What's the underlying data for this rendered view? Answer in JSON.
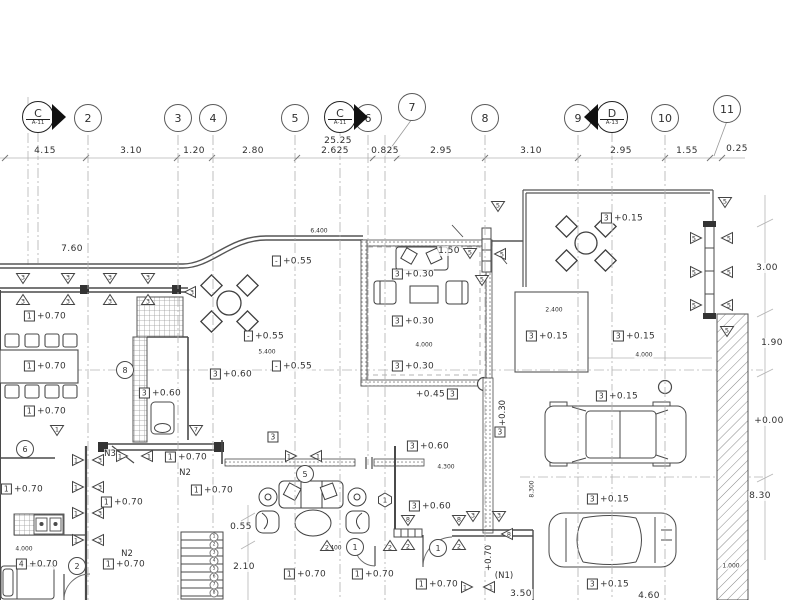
{
  "drawing": {
    "type": "architectural-floor-plan",
    "bg_color": "#ffffff",
    "line_color": "#444444"
  },
  "grid": {
    "total_dim": "25.25",
    "section_markers": [
      {
        "label": "C",
        "sheet": "A-11",
        "x": 38,
        "dir": "right",
        "yb": 263
      },
      {
        "label": "C",
        "sheet": "A-11",
        "x": 340,
        "dir": "right",
        "yb": 600
      },
      {
        "label": "D",
        "sheet": "A-13",
        "x": 612,
        "dir": "left",
        "yb": 600
      }
    ],
    "bubbles": [
      {
        "n": "2",
        "x": 88,
        "yb": 600
      },
      {
        "n": "3",
        "x": 178,
        "yb": 600
      },
      {
        "n": "4",
        "x": 213,
        "yb": 600
      },
      {
        "n": "5",
        "x": 295,
        "yb": 600
      },
      {
        "n": "6",
        "x": 368,
        "yb": 465
      },
      {
        "n": "7",
        "x": 412,
        "y": 107,
        "lx": 385,
        "yb": 600
      },
      {
        "n": "8",
        "x": 485,
        "yb": 600
      },
      {
        "n": "9",
        "x": 578,
        "yb": 600
      },
      {
        "n": "10",
        "x": 665,
        "yb": 600
      },
      {
        "n": "11",
        "x": 727,
        "y": 109,
        "lx": 714,
        "yb": 156
      }
    ],
    "ticks": [
      5,
      86,
      177,
      212,
      297,
      373,
      397,
      485,
      578,
      665,
      710,
      722
    ],
    "dims": [
      {
        "v": "4.15",
        "x": 45
      },
      {
        "v": "3.10",
        "x": 131
      },
      {
        "v": "1.20",
        "x": 194
      },
      {
        "v": "2.80",
        "x": 253
      },
      {
        "v": "2.625",
        "x": 335
      },
      {
        "v": "0.825",
        "x": 385
      },
      {
        "v": "2.95",
        "x": 441
      },
      {
        "v": "3.10",
        "x": 531
      },
      {
        "v": "2.95",
        "x": 621
      },
      {
        "v": "1.55",
        "x": 687
      }
    ]
  },
  "levels": [
    {
      "t": "1",
      "v": "+0.70",
      "x": 45,
      "y": 316
    },
    {
      "t": "1",
      "v": "+0.70",
      "x": 45,
      "y": 366
    },
    {
      "t": "1",
      "v": "+0.70",
      "x": 45,
      "y": 411
    },
    {
      "t": "1",
      "v": "+0.70",
      "x": 22,
      "y": 489
    },
    {
      "t": "1",
      "v": "+0.70",
      "x": 186,
      "y": 457
    },
    {
      "t": "1",
      "v": "+0.70",
      "x": 122,
      "y": 502
    },
    {
      "t": "1",
      "v": "+0.70",
      "x": 212,
      "y": 490
    },
    {
      "t": "4",
      "v": "+0.70",
      "x": 37,
      "y": 564
    },
    {
      "t": "1",
      "v": "+0.70",
      "x": 124,
      "y": 564
    },
    {
      "t": "1",
      "v": "+0.70",
      "x": 305,
      "y": 574
    },
    {
      "t": "1",
      "v": "+0.70",
      "x": 373,
      "y": 574
    },
    {
      "t": "1",
      "v": "+0.70",
      "x": 437,
      "y": 584
    },
    {
      "t": "3",
      "v": "+0.60",
      "x": 160,
      "y": 393
    },
    {
      "t": "3",
      "v": "+0.60",
      "x": 231,
      "y": 374
    },
    {
      "t": "3",
      "v": "+0.60",
      "x": 428,
      "y": 446
    },
    {
      "t": "3",
      "v": "+0.60",
      "x": 430,
      "y": 506
    },
    {
      "t": "3",
      "v": "+0.30",
      "x": 413,
      "y": 274
    },
    {
      "t": "3",
      "v": "+0.30",
      "x": 413,
      "y": 321
    },
    {
      "t": "3",
      "v": "+0.30",
      "x": 413,
      "y": 366
    },
    {
      "t": "3",
      "v": "+0.15",
      "x": 622,
      "y": 218
    },
    {
      "t": "3",
      "v": "+0.15",
      "x": 547,
      "y": 336
    },
    {
      "t": "3",
      "v": "+0.15",
      "x": 634,
      "y": 336
    },
    {
      "t": "3",
      "v": "+0.15",
      "x": 617,
      "y": 396
    },
    {
      "t": "3",
      "v": "+0.15",
      "x": 608,
      "y": 499
    },
    {
      "t": "3",
      "v": "+0.15",
      "x": 608,
      "y": 584
    },
    {
      "t": "-",
      "v": "+0.55",
      "x": 292,
      "y": 261
    },
    {
      "t": "-",
      "v": "+0.55",
      "x": 264,
      "y": 336
    },
    {
      "t": "-",
      "v": "+0.55",
      "x": 292,
      "y": 366
    },
    {
      "t": "3",
      "v": "+0.45",
      "x": 437,
      "y": 394,
      "f": 1
    },
    {
      "t": "3",
      "v": "",
      "x": 273,
      "y": 437
    },
    {
      "t": "3",
      "v": "",
      "x": 500,
      "y": 432
    }
  ],
  "dims_other": [
    {
      "v": "7.60",
      "x": 72,
      "y": 249
    },
    {
      "v": "1.50",
      "x": 449,
      "y": 251
    },
    {
      "v": "0.55",
      "x": 241,
      "y": 527
    },
    {
      "v": "2.10",
      "x": 244,
      "y": 567
    },
    {
      "v": "3.50",
      "x": 521,
      "y": 594
    },
    {
      "v": "4.60",
      "x": 649,
      "y": 596
    },
    {
      "v": "3.00",
      "x": 767,
      "y": 268
    },
    {
      "v": "1.90",
      "x": 772,
      "y": 343
    },
    {
      "v": "+0.00",
      "x": 769,
      "y": 421
    },
    {
      "v": "8.30",
      "x": 760,
      "y": 496
    },
    {
      "v": "0.25",
      "x": 737,
      "y": 149
    },
    {
      "v": "6.400",
      "x": 319,
      "y": 231,
      "s": 1
    },
    {
      "v": "5.400",
      "x": 267,
      "y": 352,
      "s": 1
    },
    {
      "v": "5.400",
      "x": 333,
      "y": 548,
      "s": 1
    },
    {
      "v": "4.000",
      "x": 424,
      "y": 345,
      "s": 1
    },
    {
      "v": "4.000",
      "x": 644,
      "y": 355,
      "s": 1
    },
    {
      "v": "4.300",
      "x": 446,
      "y": 467,
      "s": 1
    },
    {
      "v": "2.400",
      "x": 554,
      "y": 310,
      "s": 1
    },
    {
      "v": "4.000",
      "x": 24,
      "y": 549,
      "s": 1
    },
    {
      "v": "1.000",
      "x": 731,
      "y": 566,
      "s": 1
    },
    {
      "v": "8.300",
      "x": 532,
      "y": 489,
      "s": 1,
      "r": 1
    }
  ],
  "triangle_markers": [
    {
      "n": "3",
      "x": 23,
      "y": 279,
      "d": "d"
    },
    {
      "n": "3",
      "x": 23,
      "y": 300,
      "d": "u"
    },
    {
      "n": "3",
      "x": 68,
      "y": 279,
      "d": "d"
    },
    {
      "n": "3",
      "x": 68,
      "y": 300,
      "d": "u"
    },
    {
      "n": "3",
      "x": 110,
      "y": 279,
      "d": "d"
    },
    {
      "n": "3",
      "x": 110,
      "y": 300,
      "d": "u"
    },
    {
      "n": "3",
      "x": 148,
      "y": 279,
      "d": "d"
    },
    {
      "n": "3",
      "x": 148,
      "y": 300,
      "d": "u"
    },
    {
      "n": "3",
      "x": 190,
      "y": 292,
      "d": "l"
    },
    {
      "n": "1",
      "x": 57,
      "y": 431,
      "d": "d"
    },
    {
      "n": "7",
      "x": 196,
      "y": 431,
      "d": "d"
    },
    {
      "n": "1",
      "x": 122,
      "y": 456,
      "d": "r"
    },
    {
      "n": "1",
      "x": 147,
      "y": 456,
      "d": "l"
    },
    {
      "n": "1",
      "x": 291,
      "y": 456,
      "d": "r"
    },
    {
      "n": "1",
      "x": 316,
      "y": 456,
      "d": "l"
    },
    {
      "n": "1",
      "x": 78,
      "y": 460,
      "d": "r"
    },
    {
      "n": "3",
      "x": 98,
      "y": 460,
      "d": "l"
    },
    {
      "n": "1",
      "x": 78,
      "y": 487,
      "d": "r"
    },
    {
      "n": "3",
      "x": 98,
      "y": 487,
      "d": "l"
    },
    {
      "n": "1",
      "x": 78,
      "y": 513,
      "d": "r"
    },
    {
      "n": "3",
      "x": 98,
      "y": 513,
      "d": "l"
    },
    {
      "n": "1",
      "x": 78,
      "y": 540,
      "d": "r"
    },
    {
      "n": "3",
      "x": 98,
      "y": 540,
      "d": "l"
    },
    {
      "n": "5",
      "x": 498,
      "y": 207,
      "d": "d"
    },
    {
      "n": "5",
      "x": 470,
      "y": 254,
      "d": "d"
    },
    {
      "n": "5",
      "x": 500,
      "y": 254,
      "d": "l"
    },
    {
      "n": "5",
      "x": 482,
      "y": 281,
      "d": "d"
    },
    {
      "n": "5",
      "x": 725,
      "y": 203,
      "d": "d"
    },
    {
      "n": "5",
      "x": 696,
      "y": 238,
      "d": "r"
    },
    {
      "n": "5",
      "x": 727,
      "y": 238,
      "d": "l"
    },
    {
      "n": "5",
      "x": 696,
      "y": 272,
      "d": "r"
    },
    {
      "n": "5",
      "x": 727,
      "y": 272,
      "d": "l"
    },
    {
      "n": "5",
      "x": 696,
      "y": 305,
      "d": "r"
    },
    {
      "n": "5",
      "x": 727,
      "y": 305,
      "d": "l"
    },
    {
      "n": "5",
      "x": 727,
      "y": 332,
      "d": "d"
    },
    {
      "n": "8",
      "x": 408,
      "y": 521,
      "d": "d"
    },
    {
      "n": "2",
      "x": 408,
      "y": 545,
      "d": "u"
    },
    {
      "n": "8",
      "x": 459,
      "y": 521,
      "d": "d"
    },
    {
      "n": "2",
      "x": 459,
      "y": 545,
      "d": "u"
    },
    {
      "n": "3",
      "x": 473,
      "y": 517,
      "d": "d"
    },
    {
      "n": "3",
      "x": 499,
      "y": 517,
      "d": "d"
    },
    {
      "n": "8",
      "x": 507,
      "y": 534,
      "d": "l"
    },
    {
      "n": "2",
      "x": 327,
      "y": 546,
      "d": "u"
    },
    {
      "n": "2",
      "x": 390,
      "y": 546,
      "d": "u"
    },
    {
      "n": "1",
      "x": 467,
      "y": 587,
      "d": "r"
    },
    {
      "n": "1",
      "x": 489,
      "y": 587,
      "d": "l"
    }
  ],
  "circle_markers": [
    {
      "n": "8",
      "x": 125,
      "y": 370
    },
    {
      "n": "6",
      "x": 25,
      "y": 449
    },
    {
      "n": "2",
      "x": 77,
      "y": 566
    },
    {
      "n": "5",
      "x": 305,
      "y": 474
    },
    {
      "n": "1",
      "x": 438,
      "y": 548
    },
    {
      "n": "1",
      "x": 355,
      "y": 547
    }
  ],
  "hex_markers": [
    {
      "n": "1",
      "x": 385,
      "y": 500
    }
  ],
  "notes": [
    {
      "t": "N3",
      "x": 110,
      "y": 454
    },
    {
      "t": "N2",
      "x": 185,
      "y": 473
    },
    {
      "t": "N2",
      "x": 127,
      "y": 554
    },
    {
      "t": "(N1)",
      "x": 504,
      "y": 576
    },
    {
      "t": "+0.70",
      "x": 489,
      "y": 558,
      "r": 1
    },
    {
      "t": "+0.30",
      "x": 503,
      "y": 413,
      "r": 1
    }
  ],
  "stairs": {
    "treads": 8,
    "numbers": [
      "1",
      "2",
      "3",
      "4",
      "5",
      "6",
      "7",
      "8"
    ]
  }
}
